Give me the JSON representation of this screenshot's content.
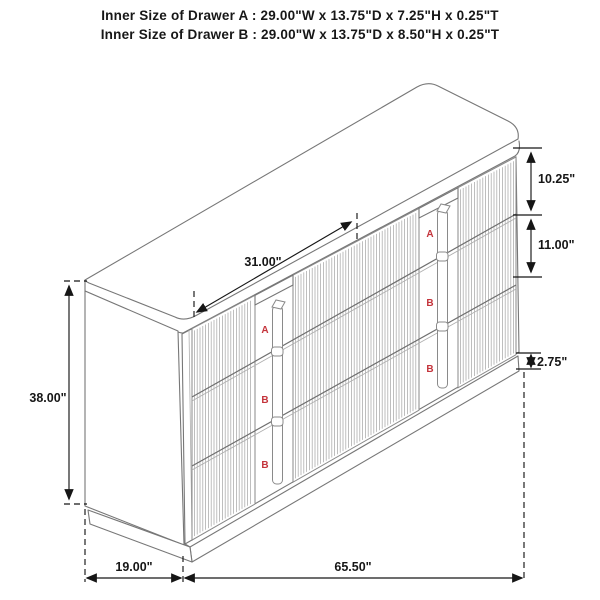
{
  "title": {
    "line1": "Inner Size of Drawer A : 29.00\"W x 13.75\"D x 7.25\"H x 0.25\"T",
    "line2": "Inner Size of Drawer B : 29.00\"W x 13.75\"D x 8.50\"H x 0.25\"T"
  },
  "dimensions": {
    "door_width": "31.00\"",
    "drawer_a_height": "10.25\"",
    "drawer_b_height": "11.00\"",
    "base_height": "2.75\"",
    "overall_height": "38.00\"",
    "depth": "19.00\"",
    "width": "65.50\""
  },
  "drawer_columns": {
    "left": [
      "A",
      "B",
      "B"
    ],
    "right": [
      "A",
      "B",
      "B"
    ]
  },
  "colors": {
    "line_gray": "#777777",
    "flute_gray": "#a9a9a9",
    "dimension_black": "#161616",
    "label_red": "#c4333b",
    "background": "#ffffff"
  }
}
